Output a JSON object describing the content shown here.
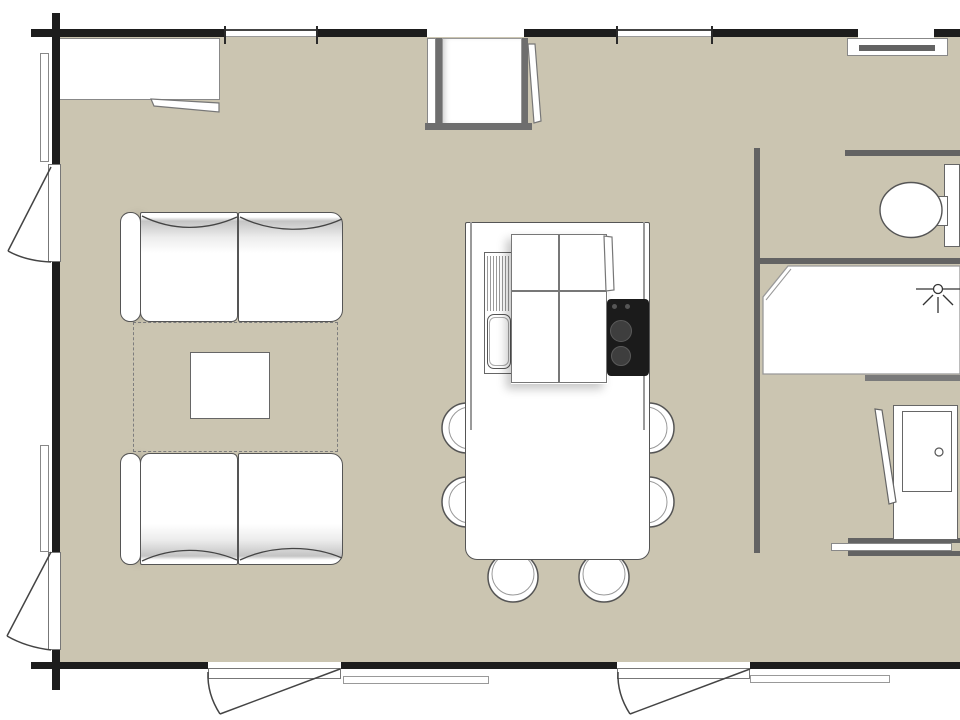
{
  "palette": {
    "floor": "#cbc5b1",
    "exterior_wall": "#1d1d1d",
    "interior_wall": "#636363",
    "furniture_outline": "#555555",
    "soft_outline": "#888888",
    "cooktop": "#1b1b1b",
    "burner": "#3e3e3e",
    "knob": "#555555",
    "shadow_bar": "#7a7a7a",
    "rug_dash": "#7d7d7d",
    "white": "#ffffff"
  },
  "items": {
    "plan": "floor-plan",
    "living": [
      "sofa-top",
      "sofa-bottom",
      "rug",
      "coffee-table",
      "wall-cabinet"
    ],
    "kitchen": [
      "island-counter",
      "sink",
      "drainboard",
      "basin",
      "cabinet-panels",
      "cooktop",
      "dining-chairs"
    ],
    "bathroom": [
      "toilet",
      "cistern",
      "shower",
      "shower-head"
    ],
    "right-rooms": [
      "wardrobe",
      "sliding-door"
    ],
    "openings": [
      "entry-door",
      "left-door-upper",
      "left-door-lower",
      "bottom-door-left",
      "bottom-door-right",
      "windows"
    ],
    "counts": {
      "dining_chairs": 6,
      "sofas": 2,
      "exterior_doors": 5,
      "steps": 2
    }
  }
}
